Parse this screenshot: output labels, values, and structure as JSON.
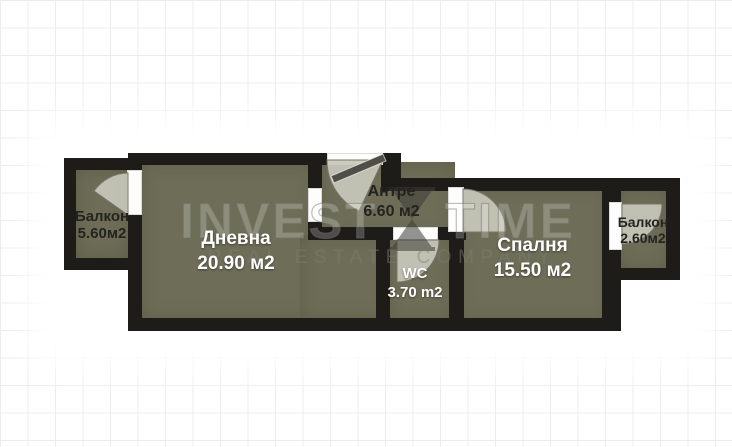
{
  "watermark": {
    "line1_left": "INVEST",
    "line1_right": "TIME",
    "line2": "REAL ESTATE COMPANY"
  },
  "rooms": [
    {
      "id": "balcony-left",
      "name": "Балкон",
      "area": "5.60м2",
      "label_style": "dark"
    },
    {
      "id": "living-room",
      "name": "Дневна",
      "area": "20.90 м2",
      "label_style": "light"
    },
    {
      "id": "entry-hall",
      "name": "Антре",
      "area": "6.60 м2",
      "label_style": "dark"
    },
    {
      "id": "wc",
      "name": "WC",
      "area": "3.70 m2",
      "label_style": "light"
    },
    {
      "id": "bedroom",
      "name": "Спалня",
      "area": "15.50 м2",
      "label_style": "light"
    },
    {
      "id": "balcony-right",
      "name": "Балкон",
      "area": "2.60м2",
      "label_style": "dark"
    }
  ],
  "colors": {
    "wall": "#1d1c19",
    "floor": "#6e6e58",
    "opening": "#fdfdfb",
    "door_swing": "#c8c8bb",
    "grid_line": "#ececec",
    "label_dark": "#23231f",
    "label_light": "#ffffff"
  }
}
